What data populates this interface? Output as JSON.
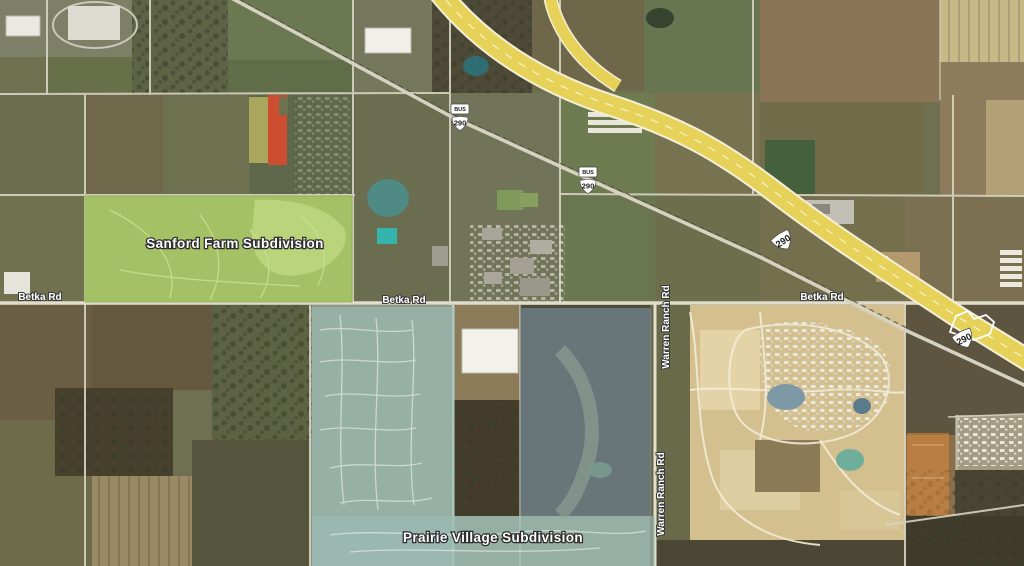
{
  "map": {
    "type": "satellite-aerial-view",
    "labels": {
      "sanford_farm": "Sanford Farm Subdivision",
      "prairie_village": "Prairie Village Subdivision",
      "betka_rd": "Betka Rd",
      "warren_ranch_rd": "Warren Ranch Rd"
    },
    "route_shields": {
      "us_290": "290",
      "business_banner": "BUS"
    },
    "highlight_colors": {
      "sanford_farm_green": "#a9c768",
      "prairie_village_teal": "#9dbfb6",
      "prairie_village_blue": "#7d93a4",
      "parcel_red": "#d64b2e",
      "parcel_olive": "#b2ab5f",
      "parcel_orange": "#e08a3c",
      "highway_yellow": "#e6d258"
    }
  }
}
